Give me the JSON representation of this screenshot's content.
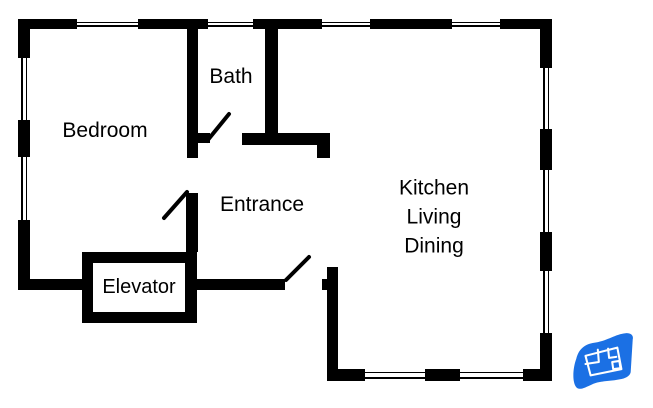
{
  "page": {
    "type": "floor-plan-diagram",
    "background": "#ffffff",
    "wall_color": "#000000",
    "logo_color": "#1b70e4"
  },
  "labels": {
    "bedroom": "Bedroom",
    "bath": "Bath",
    "entrance": "Entrance",
    "elevator": "Elevator",
    "kitchen_lines": [
      "Kitchen",
      "Living",
      "Dining"
    ]
  },
  "icons": [
    {
      "name": "blueprint-logo-icon",
      "meaning": "blue waving blueprint flag watermark"
    }
  ],
  "features": {
    "doors": 3,
    "windows": 11,
    "elevator_shaft": 1
  }
}
